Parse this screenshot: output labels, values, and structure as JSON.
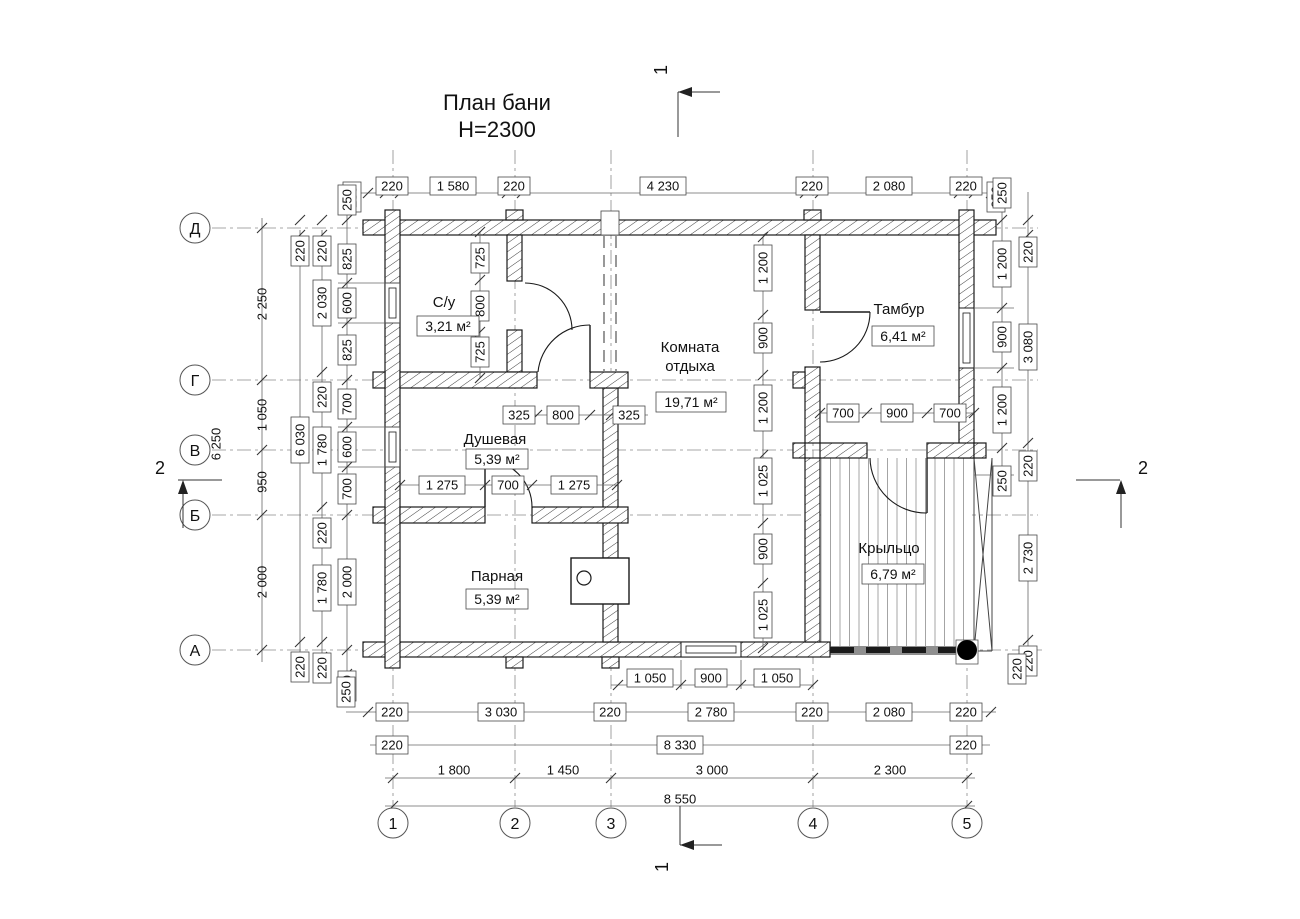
{
  "title": {
    "line1": "План бани",
    "line2": "Н=2300"
  },
  "sections": {
    "cut1": "1",
    "cut2": "2"
  },
  "axes": {
    "rows": [
      "Д",
      "Г",
      "В",
      "Б",
      "А"
    ],
    "cols": [
      "1",
      "2",
      "3",
      "4",
      "5"
    ]
  },
  "rooms": [
    {
      "name": "С/у",
      "area": "3,21 м²"
    },
    {
      "name": "Душевая",
      "area": "5,39 м²"
    },
    {
      "name": "Парная",
      "area": "5,39 м²"
    },
    {
      "name": "Комната",
      "name2": "отдыха",
      "area": "19,71 м²"
    },
    {
      "name": "Тамбур",
      "area": "6,41 м²"
    },
    {
      "name": "Крыльцо",
      "area": "6,79 м²"
    }
  ],
  "dims": {
    "top": [
      "250",
      "220",
      "1 580",
      "220",
      "4 230",
      "220",
      "2 080",
      "220",
      "250"
    ],
    "left_overall": [
      "2 250",
      "1 050",
      "950",
      "2 000"
    ],
    "left_total": "6 250",
    "left_chain2": [
      "220",
      "6 030",
      "220"
    ],
    "left_chain3": [
      "220",
      "2 030",
      "220",
      "1 780",
      "220",
      "1 780",
      "220"
    ],
    "left_chain4": [
      "250",
      "825",
      "600",
      "825",
      "700",
      "600",
      "700",
      "2 000",
      "250"
    ],
    "right_inner": [
      "250",
      "1 200",
      "900",
      "1 200",
      "250"
    ],
    "right_outer": [
      "220",
      "3 080",
      "220",
      "2 730",
      "220"
    ],
    "bottom_window": [
      "1 050",
      "900",
      "1 050"
    ],
    "bottom_chain1": [
      "250",
      "220",
      "3 030",
      "220",
      "2 780",
      "220",
      "2 080",
      "220",
      "220"
    ],
    "bottom_chain2": [
      "220",
      "8 330",
      "220"
    ],
    "bottom_spans": [
      "1 800",
      "1 450",
      "3 000",
      "2 300"
    ],
    "bottom_total": "8 550",
    "syu_v": [
      "725",
      "800",
      "725"
    ],
    "syu_h": [
      "325",
      "800",
      "325"
    ],
    "dush": [
      "1 275",
      "700",
      "1 275"
    ],
    "tambur": [
      "700",
      "900",
      "700"
    ],
    "lounge": [
      "1 200",
      "900",
      "1 200",
      "1 025",
      "900",
      "1 025"
    ],
    "porch_edge": "2 730"
  }
}
